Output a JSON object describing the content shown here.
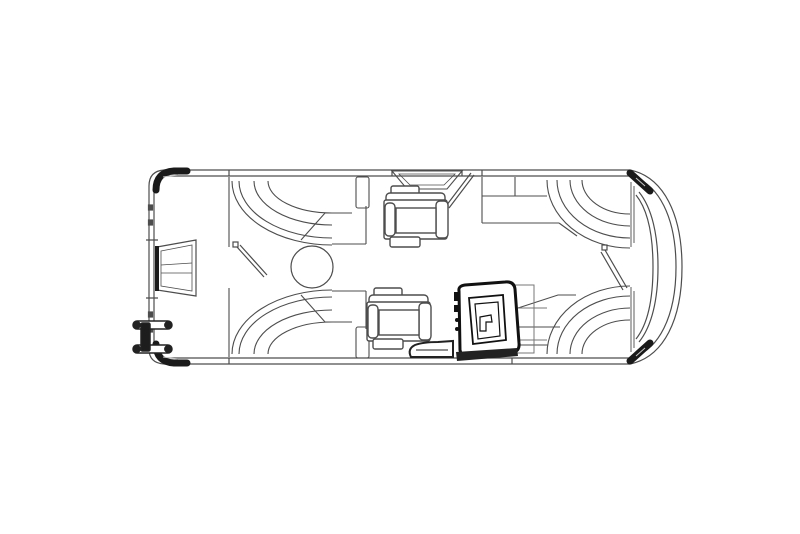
{
  "page": {
    "title": "Pontoon Boat Floor Plan",
    "description": "Black-and-white top-view line drawing of a pontoon boat floor plan with bow lounges, rear lounges, two captain chairs, helm console, round table, stern motor and boarding ladder"
  },
  "drawing": {
    "background": "#ffffff",
    "line_color": "#4d4d4d",
    "light_line_color": "#9a9a9a",
    "dark_color": "#1a1a1a",
    "fill_color": "#ffffff",
    "parts": {
      "deck_rails": "deck-and-fence-rails",
      "corner_caps": "corner-caps",
      "outboard_motor": "outboard-motor",
      "boarding_ladder": "boarding-ladder",
      "stern_gate_door": "stern-gate-door",
      "top_gate_door": "side-gate-door",
      "bow_gate_door": "bow-gate-door",
      "gate_step": "side-gate-step",
      "rear_lounge_upper": "rear-lounge-upper",
      "rear_lounge_lower": "rear-lounge-lower",
      "bow_lounge_upper": "bow-lounge-upper",
      "bow_lounge_lower": "bow-lounge-lower",
      "captain_chair_upper": "captain-chair-upper",
      "captain_chair_lower": "captain-chair-lower",
      "round_table": "round-table",
      "helm_console": "helm-console",
      "helm_step": "helm-step"
    }
  }
}
